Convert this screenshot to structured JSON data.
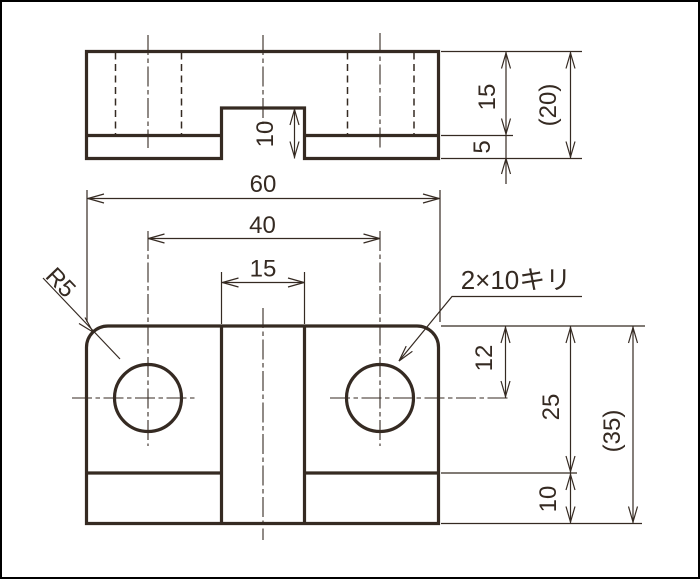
{
  "drawing": {
    "background": "#ffffff",
    "frame_color": "#000000",
    "line_color": "#352a22",
    "views": {
      "front_view": "front-view",
      "plan_view": "plan-view"
    },
    "dims": {
      "overall_width": "60",
      "hole_spacing": "40",
      "slot_width": "15",
      "slot_height": "10",
      "upper_height": "15",
      "flange_height": "5",
      "overall_height_ref": "(20)",
      "hole_offset": "12",
      "body_depth": "25",
      "flange_depth": "10",
      "overall_depth_ref": "(35)",
      "corner_radius": "R5",
      "hole_note": "2×10キリ"
    }
  }
}
